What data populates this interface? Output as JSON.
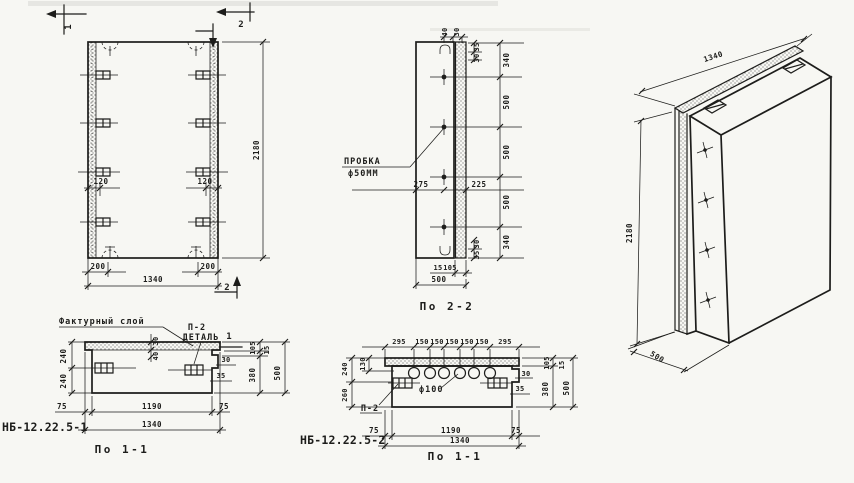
{
  "palette": {
    "paper": "#f7f7f3",
    "ink": "#1d1d1b"
  },
  "front_view": {
    "section_mark_1": "1",
    "section_mark_2_top": "2",
    "section_mark_2_bottom": "2",
    "dim_height": "2180",
    "dim_anchor_left": "120",
    "dim_anchor_right": "120",
    "dim_edge_left": "200",
    "dim_edge_right": "200",
    "dim_width": "1340"
  },
  "section_2_2": {
    "title": "По 2-2",
    "plug_label_line1": "ПРОБКА",
    "plug_label_line2": "ф50ММ",
    "dim_top_40": "40",
    "dim_top_30": "30",
    "dim_edge_top_35": "35",
    "dim_edge_top_30": "30",
    "right_dims": [
      "340",
      "500",
      "500",
      "500",
      "340"
    ],
    "dim_mid_left": "275",
    "dim_mid_right": "225",
    "dim_edge_bot_30": "30",
    "dim_edge_bot_35": "35",
    "dim_bot_15": "15",
    "dim_bot_105": "105",
    "dim_bot_total": "500"
  },
  "iso_view": {
    "dim_width": "1340",
    "dim_height": "2180",
    "dim_depth": "500"
  },
  "section_a": {
    "code": "НБ-12.22.5-1",
    "title": "По 1-1",
    "texture_label": "Фактурный слой",
    "detail_ref": "П-2",
    "detail_label": "ДЕТАЛЬ",
    "detail_mark": "1",
    "dim_layer_30": "30",
    "dim_layer_40": "40",
    "left_dims": [
      "240",
      "240"
    ],
    "dim_step_30": "30",
    "dim_step_35": "35",
    "right_dims": [
      "105",
      "15",
      "380",
      "500"
    ],
    "bottom_dims": [
      "75",
      "1190",
      "75"
    ],
    "dim_total": "1340"
  },
  "section_b": {
    "code": "НБ-12.22.5-2",
    "title": "По 1-1",
    "top_dims": [
      "295",
      "150",
      "150",
      "150",
      "150",
      "150",
      "295"
    ],
    "left_dims": [
      "240",
      "130",
      "260"
    ],
    "holes_label": "ф100",
    "detail_ref": "П-2",
    "dim_step_30": "30",
    "dim_step_35": "35",
    "right_dims": [
      "105",
      "15",
      "380",
      "500"
    ],
    "bottom_dims": [
      "75",
      "1190",
      "75"
    ],
    "dim_total": "1340"
  }
}
